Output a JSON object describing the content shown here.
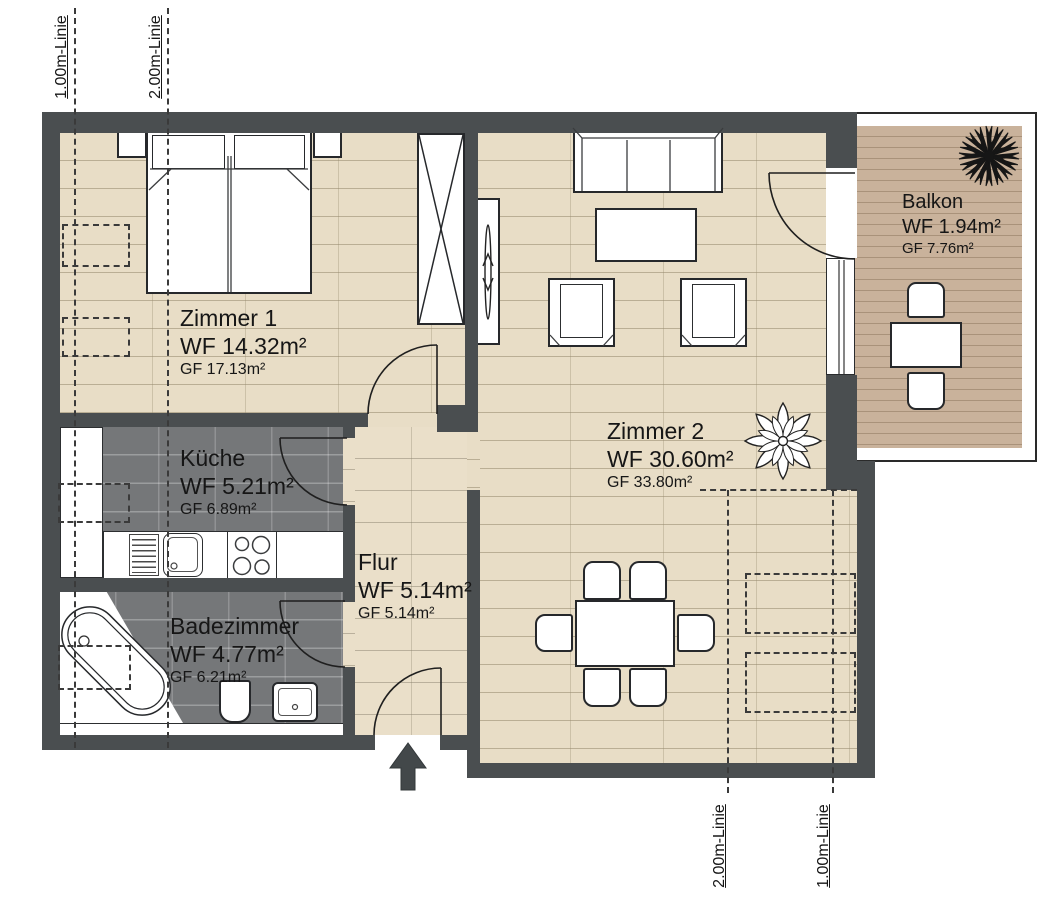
{
  "plan": {
    "rooms": {
      "zimmer1": {
        "name": "Zimmer 1",
        "wf": "WF 14.32m²",
        "gf": "GF 17.13m²"
      },
      "kueche": {
        "name": "Küche",
        "wf": "WF 5.21m²",
        "gf": "GF 6.89m²"
      },
      "badezimmer": {
        "name": "Badezimmer",
        "wf": "WF 4.77m²",
        "gf": "GF 6.21m²"
      },
      "flur": {
        "name": "Flur",
        "wf": "WF 5.14m²",
        "gf": "GF 5.14m²"
      },
      "zimmer2": {
        "name": "Zimmer 2",
        "wf": "WF 30.60m²",
        "gf": "GF 33.80m²"
      },
      "balkon": {
        "name": "Balkon",
        "wf": "WF 1.94m²",
        "gf": "GF 7.76m²"
      }
    },
    "guides": {
      "top_1m": "1.00m-Linie",
      "top_2m": "2.00m-Linie",
      "bottom_2m": "2.00m-Linie",
      "bottom_1m": "1.00m-Linie"
    },
    "colors": {
      "wall": "#4a4e50",
      "wood_floor": "#e8ddc6",
      "dark_tile": "#757779",
      "balcony_deck": "#c9b29b",
      "line": "#26282b"
    }
  }
}
